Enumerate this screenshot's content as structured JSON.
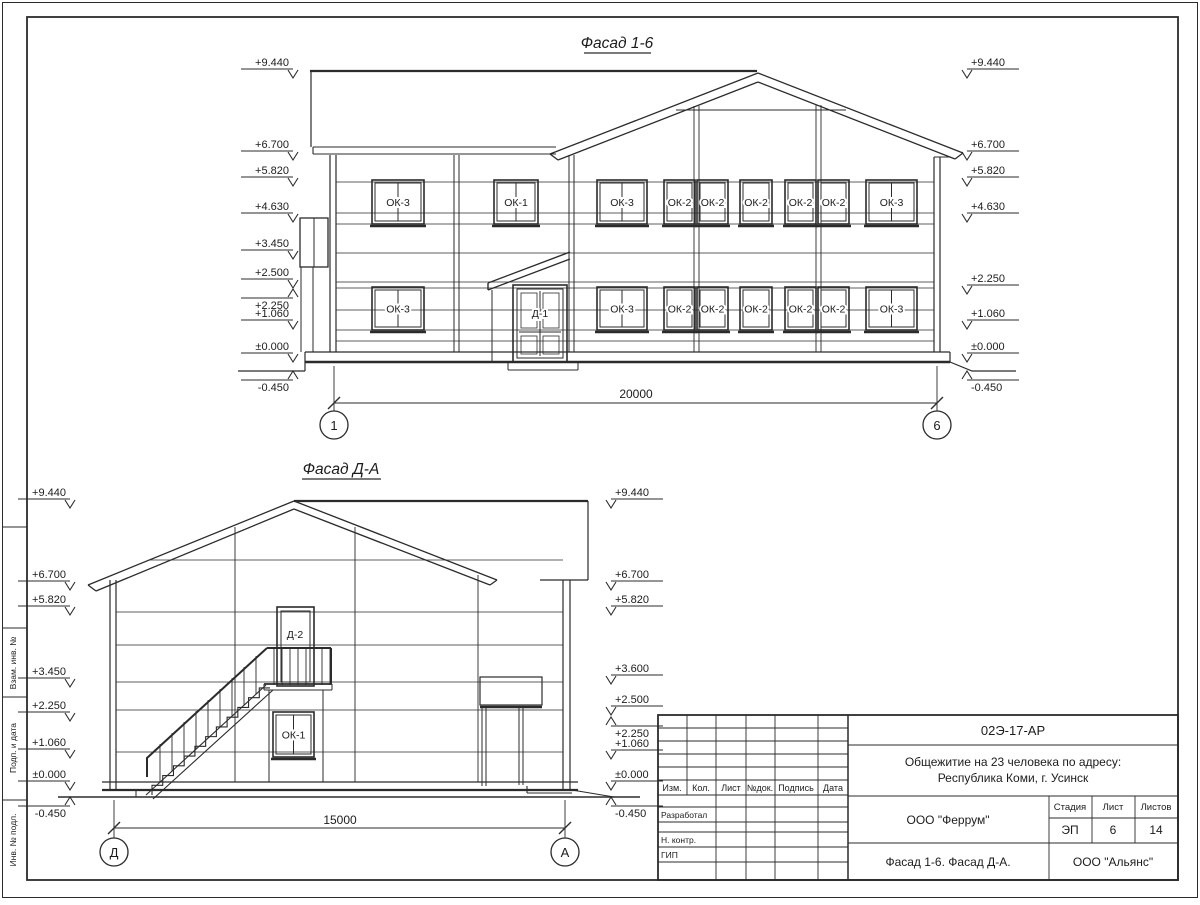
{
  "drawing": {
    "facade_1_6": {
      "title": "Фасад 1-6",
      "left_elevations": [
        "+9.440",
        "+6.700",
        "+5.820",
        "+4.630",
        "+3.450",
        "+2.500",
        "+2.250",
        "+1.060",
        "±0.000",
        "-0.450"
      ],
      "right_elevations": [
        "+9.440",
        "+6.700",
        "+5.820",
        "+4.630",
        "+2.250",
        "+1.060",
        "±0.000",
        "-0.450"
      ],
      "upper_windows": [
        "ОК-3",
        "ОК-1",
        "ОК-3",
        "ОК-2",
        "ОК-2",
        "ОК-2",
        "ОК-2",
        "ОК-2",
        "ОК-3"
      ],
      "lower_windows": [
        "ОК-3",
        "ОК-3",
        "ОК-2",
        "ОК-2",
        "ОК-2",
        "ОК-2",
        "ОК-2",
        "ОК-3"
      ],
      "door_label": "Д-1",
      "dimension": "20000",
      "axis_left": "1",
      "axis_right": "6"
    },
    "facade_d_a": {
      "title": "Фасад Д-А",
      "left_elevations": [
        "+9.440",
        "+6.700",
        "+5.820",
        "+3.450",
        "+2.250",
        "+1.060",
        "±0.000",
        "-0.450"
      ],
      "right_elevations": [
        "+9.440",
        "+6.700",
        "+5.820",
        "+3.600",
        "+2.500",
        "+2.250",
        "+1.060",
        "±0.000",
        "-0.450"
      ],
      "door_label": "Д-2",
      "window_label": "ОК-1",
      "dimension": "15000",
      "axis_left": "Д",
      "axis_right": "А"
    }
  },
  "title_block": {
    "doc_number": "02Э-17-АР",
    "project_line1": "Общежитие на 23 человека по адресу:",
    "project_line2": "Республика Коми, г. Усинск",
    "designer_org": "ООО \"Феррум\"",
    "stage_label": "Стадия",
    "sheet_label": "Лист",
    "sheets_label": "Листов",
    "stage": "ЭП",
    "sheet": "6",
    "sheets": "14",
    "sheet_title": "Фасад 1-6. Фасад Д-А.",
    "contractor_org": "ООО \"Альянс\"",
    "columns": [
      "Изм.",
      "Кол.",
      "Лист",
      "№док.",
      "Подпись",
      "Дата"
    ],
    "rows": [
      "Разработал",
      "Н. контр.",
      "ГИП"
    ]
  },
  "frame": {
    "side_labels": [
      "Взам. инв. №",
      "Подп. и дата",
      "Инв. № подл."
    ]
  }
}
